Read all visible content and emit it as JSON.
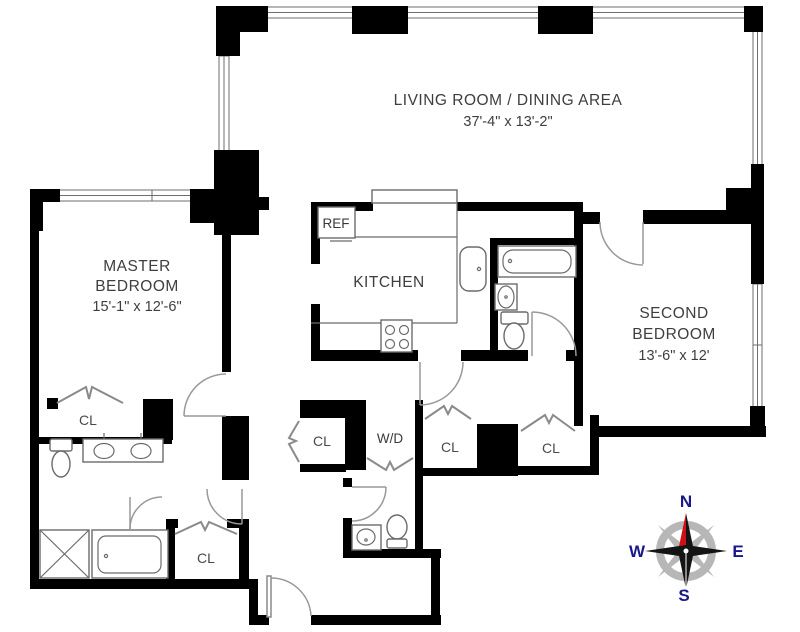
{
  "labels": {
    "living": {
      "name": "LIVING ROOM / DINING AREA",
      "dims": "37'-4\" x 13'-2\""
    },
    "master": {
      "line1": "MASTER",
      "line2": "BEDROOM",
      "dims": "15'-1\" x 12'-6\""
    },
    "second": {
      "line1": "SECOND",
      "line2": "BEDROOM",
      "dims": "13'-6\" x 12'"
    },
    "kitchen": "KITCHEN",
    "ref": "REF",
    "wd": "W/D",
    "cl": "CL"
  },
  "compass": {
    "north": "N",
    "east": "E",
    "south": "S",
    "west": "W"
  },
  "colors": {
    "wall": "#000000",
    "fixture_line": "#6b6b6b",
    "door_arc": "#999999",
    "label_text": "#3e3e3e",
    "compass_letter": "#18188c",
    "needle_red": "#d01016",
    "needle_dark": "#141414",
    "ring_gray": "#b7b7b7",
    "background": "#ffffff"
  }
}
